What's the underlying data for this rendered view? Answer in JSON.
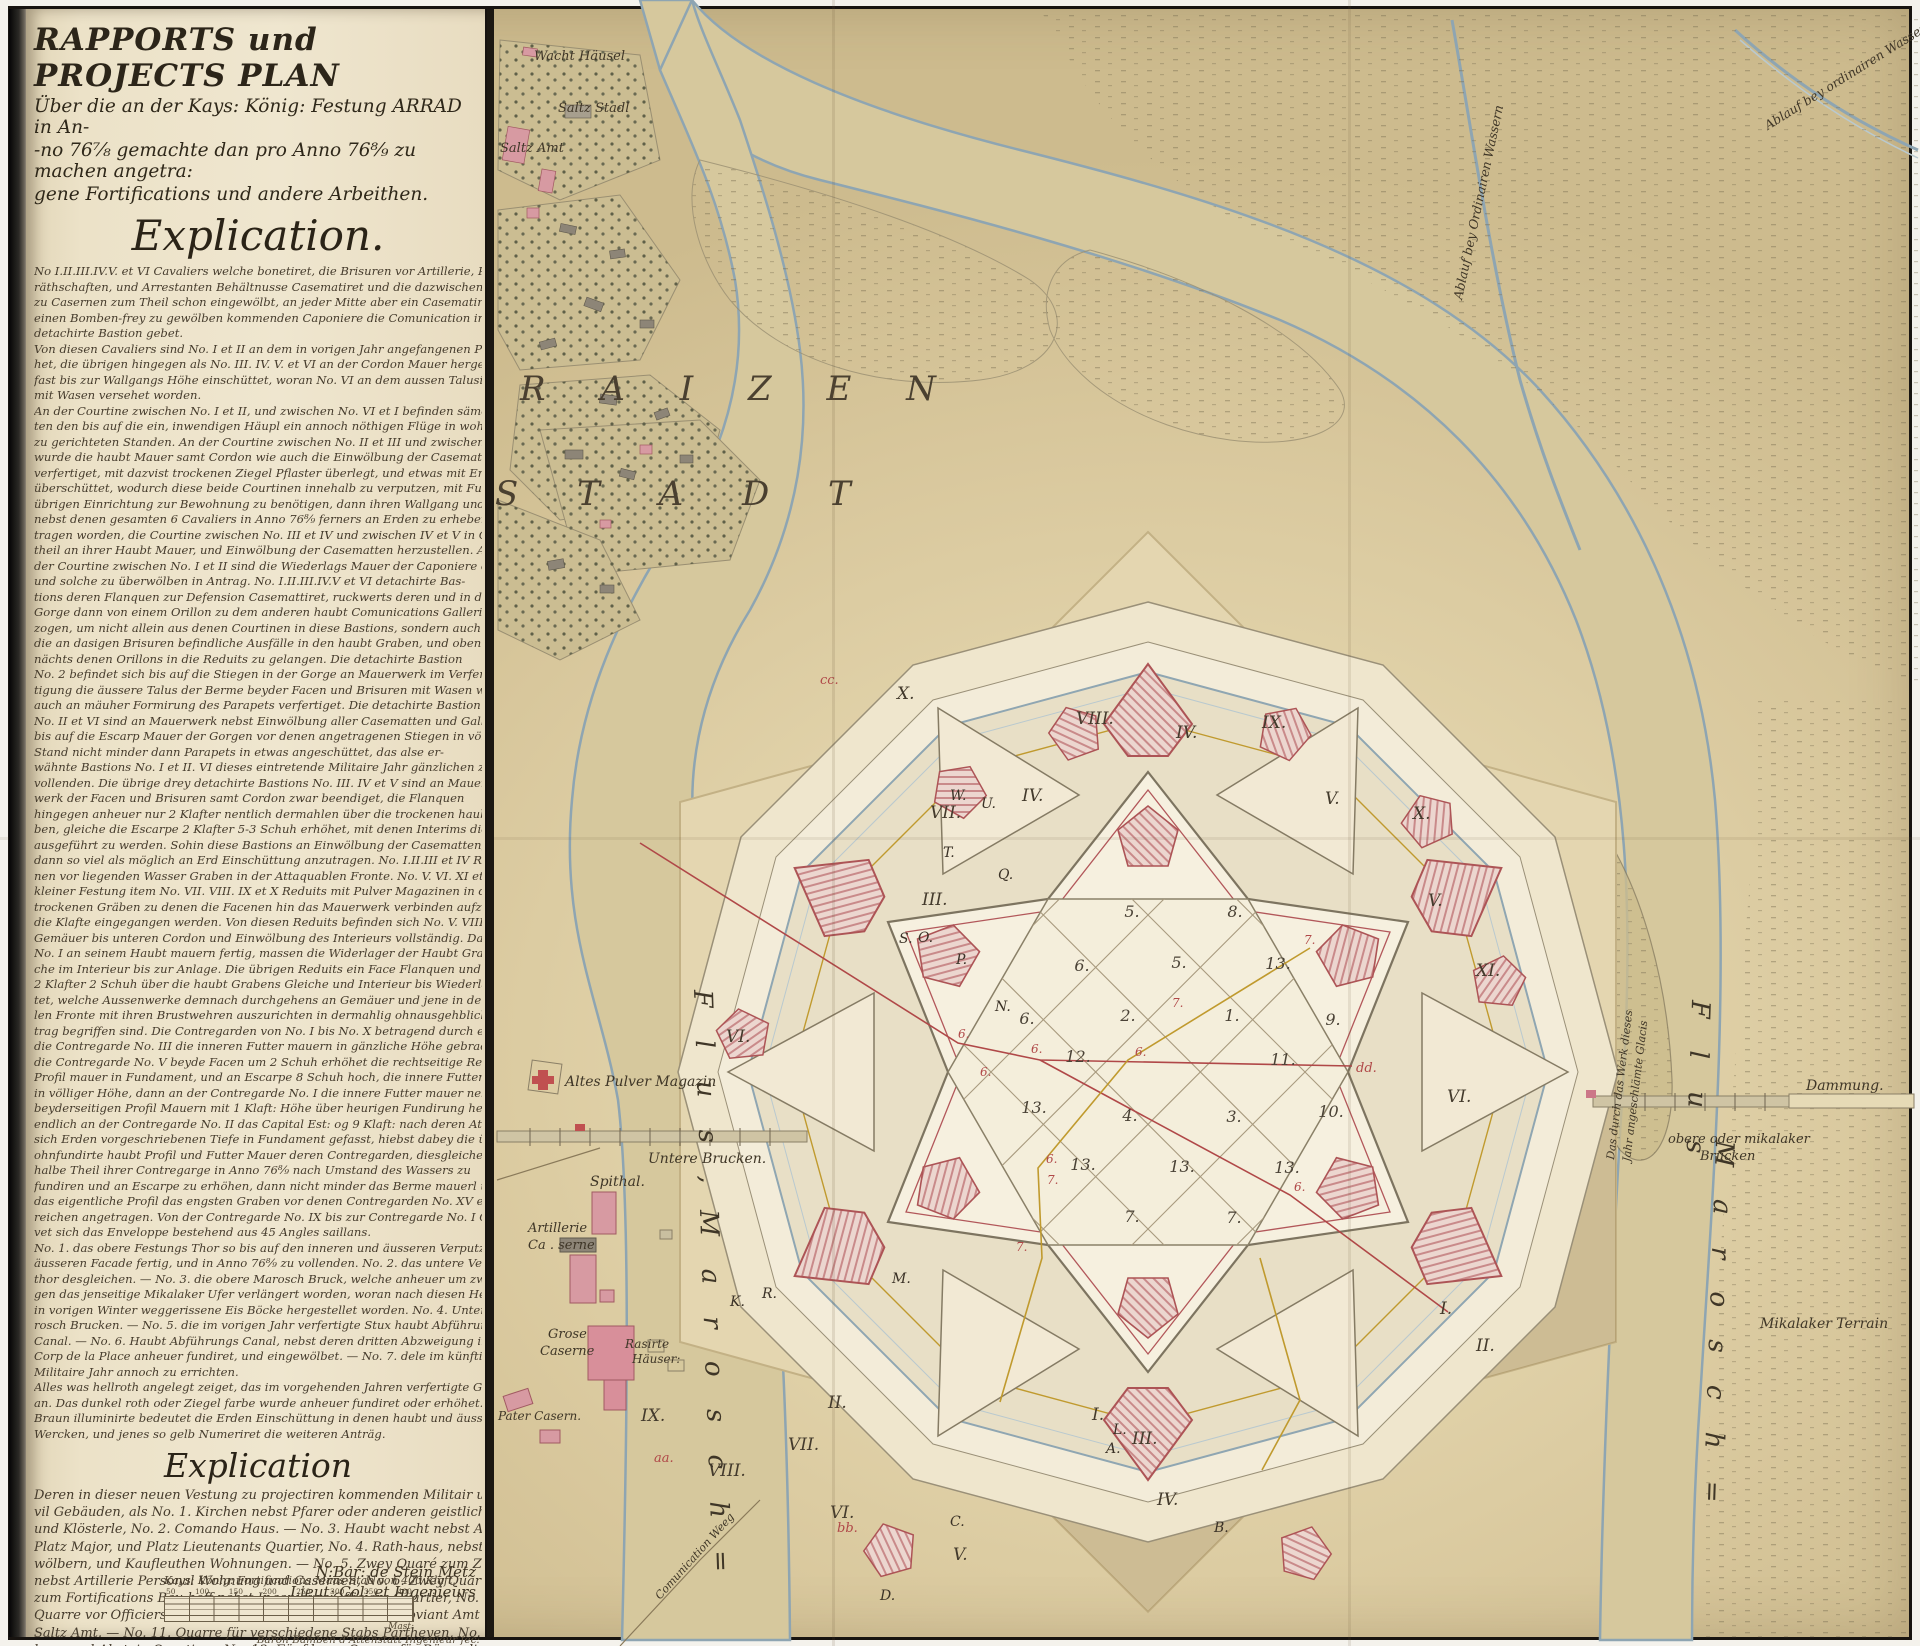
{
  "panel": {
    "title_line1": "RAPPORTS und PROJECTS PLAN",
    "title_line2": "Über die an der Kays: König: Festung ARRAD in An-",
    "title_line3": "-no 76⁷⁄₈ gemachte dan pro Anno 76⁸⁄₉ zu machen angetra:",
    "title_line4": "gene Fortifications und andere Arbeithen.",
    "explication_heading": "Explication.",
    "body_lines": [
      "No I.II.III.IV.V. et VI Cavaliers welche bonetiret, die Brisuren vor Artillerie, Proviant Ge-",
      "räthschaften, und Arrestanten Behältnusse Casematiret und die dazwischen liegende Courtinen",
      "zu Casernen zum Theil schon eingewölbt, an jeder Mitte aber ein Casematirter Ausfall durch",
      "einen Bomben-frey zu gewölben kommenden Caponiere die Comunication in die dorten liegende",
      "detachirte Bastion gebet.",
      "Von diesen Cavaliers sind No. I et II an dem in vorigen Jahr angefangenen Parapet ferners erhö-",
      "het, die übrigen hingegen als No. III. IV. V. et VI an der Cordon Mauer hergestellet, an Erden aber",
      "fast bis zur Wallgangs Höhe einschüttet, woran No. VI an dem aussen Talusirte Berme",
      "mit Wasen versehet worden.",
      "An der Courtine zwischen No. I et II, und zwischen No. VI et I befinden sämentliche Casemat-",
      "ten den bis auf die ein, inwendigen Häupl ein annoch nöthigen Flüge in wohnbaren",
      "zu gerichteten Standen. An der Courtine zwischen No. II et III und zwischen No. V et VI",
      "wurde die haubt Mauer samt Cordon wie auch die Einwölbung der Casematirten Casern",
      "verfertiget, mit dazvist trockenen Ziegel Pflaster überlegt, und etwas mit Erden",
      "überschüttet, wodurch diese beide Courtinen innehalb zu verputzen, mit Fussböden, und",
      "übrigen Einrichtung zur Bewohnung zu benötigen, dann ihren Wallgang und Brustwerke",
      "nebst denen gesamten 6 Cavaliers in Anno 76⁸⁄₉ ferners an Erden zu erheben, ange-",
      "tragen worden, die Courtine zwischen No. III et IV und zwischen IV et V in Gegen-",
      "theil an ihrer Haubt Mauer, und Einwölbung der Casematten herzustellen. An",
      "der Courtine zwischen No. I et II sind die Wiederlags Mauer der Caponiere errichtet,",
      "und solche zu überwölben in Antrag.    No. I.II.III.IV.V et VI detachirte Bas-",
      "tions deren Flanquen zur Defension Casemattiret, ruckwerts deren und in der",
      "Gorge dann von einem Orillon zu dem anderen haubt Comunications Gallerien ge-",
      "zogen, um nicht allein aus denen Courtinen in diese Bastions, sondern auch durch",
      "die an dasigen Brisuren befindliche Ausfälle in den haubt Graben, und oben",
      "nächts denen Orillons in die Reduits zu gelangen. Die detachirte Bastion",
      "No. 2 befindet sich bis auf die Stiegen in der Gorge an Mauerwerk im Verfer-",
      "tigung die äussere Talus der Berme beyder Facen und Brisuren mit Wasen wie",
      "auch an mäuher Formirung des Parapets verfertiget. Die detachirte Bastion",
      "No. II et VI sind an Mauerwerk nebst Einwölbung aller Casematten und Gallerien",
      "bis auf die Escarp Mauer der Gorgen vor denen angetragenen Stiegen in völlig neuen",
      "Stand nicht minder dann Parapets in etwas angeschüttet, das alse er-",
      "wähnte Bastions No. I et II. VI dieses eintretende Militaire Jahr gänzlichen zu",
      "vollenden. Die übrige drey detachirte Bastions No. III. IV et V sind an Mauer-",
      "werk der Facen und Brisuren samt Cordon zwar beendiget, die Flanquen",
      "hingegen anheuer nur 2 Klafter nentlich dermahlen über die trockenen haubt Grä-",
      "ben, gleiche die Escarpe 2 Klafter 5-3 Schuh erhöhet, mit denen Interims die Wiederlager",
      "ausgeführt zu werden. Sohin diese Bastions an Einwölbung der Casematten, und Gallerien,",
      "dann so viel als möglich an Erd Einschüttung anzutragen.    No. I.II.III et IV Reduits mit de-",
      "nen vor liegenden Wasser Graben in der Attaquablen Fronte. No. V. VI. XI et XII Reduits",
      "kleiner Festung item No. VII. VIII. IX et X Reduits mit Pulver Magazinen in denen",
      "trockenen Gräben zu denen die Facenen hin das Mauerwerk verbinden aufzuen,",
      "die Klafte eingegangen werden. Von diesen Reduits befinden sich No. V. VIII et VI an haubt",
      "Gemäuer bis unteren Cordon und Einwölbung des Interieurs vollständig. Das Reduit",
      "No. I an seinem Haubt mauern fertig, massen die Widerlager der Haubt Graben und sol-",
      "che im Interieur bis zur Anlage. Die übrigen Reduits ein Face Flanquen und Gorge mauern",
      "2 Klafter 2 Schuh über die haubt Grabens Gleiche und Interieur bis Wiederlager errich-",
      "tet, welche Aussenwerke demnach durchgehens an Gemäuer und jene in der attaquab-",
      "len Fronte mit ihren Brustwehren auszurichten in dermahlig ohnausgehbliche An-",
      "trag begriffen sind. Die Contregarden von No. I bis No. X betragend durch einziegen",
      "die Contregarde No. III die inneren Futter mauern in gänzliche Höhe gebracht, an",
      "die Contregarde No. V beyde Facen um 2 Schuh erhöhet die rechtseitige Rekierung nebst",
      "Profil mauer in Fundament, und an Escarpe 8 Schuh hoch, die innere Futter mauer aber",
      "in völliger Höhe, dann an der Contregarde No. I die innere Futter mauer nebst",
      "beyderseitigen Profil Mauern mit 1 Klaft: Höhe über heurigen Fundirung hergestellt, und",
      "endlich an der Contregarde No. II das Capital Est: og 9 Klaft: nach deren Attechoik",
      "sich Erden vorgeschriebenen Tiefe in Fundament gefasst, hiebst dabey die übrige noch",
      "ohnfundirte haubt Profil und Futter Mauer deren Contregarden, diesgleichende",
      "halbe Theil ihrer Contregarge in Anno 76⁸⁄₉ nach Umstand des Wassers zu",
      "fundiren und an Escarpe zu erhöhen, dann nicht minder das Berme mauerl um",
      "das eigentliche Profil das engsten Graben vor denen Contregarden No. XV et XI aus-",
      "reichen angetragen. Von der Contregarde No. IX bis zur Contregarde No. I Contre-",
      "vet sich das Enveloppe bestehend aus 45 Angles saillans.",
      "No. 1. das obere Festungs Thor so bis auf den inneren und äusseren Verputz dann",
      "äusseren Facade fertig, und in Anno 76⁸⁄₉ zu vollenden. No. 2. das untere Vestungs",
      "thor desgleichen. — No. 3. die obere Marosch Bruck, welche anheuer um zwey Joch ge-",
      "gen das jenseitige Mikalaker Ufer verlängert worden, woran nach diesen Herbst die",
      "in vorigen Winter weggerissene Eis Böcke hergestellet worden. No. 4. Untere Ma-",
      "rosch Brucken. — No. 5. die im vorigen Jahr verfertigte Stux haubt Abführungs",
      "Canal. — No. 6. Haubt Abführungs Canal, nebst deren dritten Abzweigung in dem",
      "Corp de la Place anheuer fundiret, und eingewölbet. — No. 7. dele im künftigen",
      "Militaire Jahr annoch zu errichten.",
      "Alles was hellroth angelegt zeiget, das im vorgehenden Jahren verfertigte Gemäuer",
      "an. Das dunkel roth oder Ziegel farbe wurde anheuer fundiret oder erhöhet. Das",
      "Braun illuminirte bedeutet die Erden Einschüttung in denen haubt und äusseren",
      "Wercken, und jenes so gelb Numeriret die weiteren Anträg."
    ],
    "explication2_heading": "Explication",
    "body2_lines": [
      "Deren in dieser neuen Vestung zu projectiren kommenden Militair und Ci-",
      "vil Gebäuden, als No. 1. Kirchen nebst Pfarer oder anderen geistlichen Wohnung",
      "und Klösterle, No. 2. Comando Haus. — No. 3. Haubt wacht nebst Arrestanten,",
      "Platz Major, und Platz Lieutenants Quartier, No. 4. Rath-haus, nebst Zinsge-",
      "wölbern, und Kaufleuthen Wohnungen. — No. 5. Zwey Quaré zum Zeughaus",
      "nebst Artillerie Personal Wohnung und Casernen, No. 6. Zwey Quarre",
      "zum Fortifications Bau-hoff nebst Ingenieurs Officiers Quartier, No. 7. Zwey",
      "Quarre vor Officiers Caserne, No. 8. Hospithal, No. 9. Proviant Amt et No. 10.",
      "Saltz Amt. — No. 11. Quarre für verschiedene Stabs Partheyen, No. 12. Für Wirths-",
      "haus und Absteig Quartiers, No. 13. Fünf leere Quarre für Bürgerliche",
      "und andere Häuser."
    ],
    "signature_line1": "N:Bar: de Stein Metz",
    "signature_line2": "Lieut: Col: et Ingenieurs",
    "scale": {
      "title": "Kays: König: Fortifications Maas-Stab von 400 Klaft.",
      "ticks": [
        "50",
        "100",
        "150",
        "200",
        "250",
        "300",
        "350",
        "400"
      ],
      "end": "Mast:"
    },
    "credit": "Baron Bamben d'Attenstatt Ingenieur fec:"
  },
  "map": {
    "labels": {
      "wacht_hausel": "Wacht Häusel",
      "saltz_stadl": "Saltz Stadl",
      "saltz_amt": "Saltz Amt",
      "raizen": "R A I Z E N",
      "stadt": "S T A D T",
      "ablauf_left": "Ablauf bey Ordinairen Wassern",
      "ablauf_right": "Ablauf bey ordinairen Wassern",
      "flus_left": "F l u s ,",
      "marosch_left": "M a r o s c h =",
      "flus_right": "F l u s",
      "marosch_right": "M a r o s c h =",
      "altes_pulver": "Altes Pulver Magazin",
      "untere_brucken": "Untere Brucken.",
      "spithal": "Spithal.",
      "artillerie_1": "Artillerie",
      "artillerie_2": "Ca . serne",
      "grose_caserne_1": "Grose",
      "grose_caserne_2": "Caserne",
      "rasirte_1": "Rasirte",
      "rasirte_2": "Häuser:",
      "pater_casern": "Pater Casern.",
      "comunication": "Comunication Weeg",
      "obere_brucken_1": "obere oder mikalaker",
      "obere_brucken_2": "Brucken",
      "dammung": "Dammung.",
      "mikalaker": "Mikalaker Terrain",
      "angeschlemte_1": "Das durch das Werk dieses",
      "angeschlemte_2": "Jahr angeschlämte Glacis"
    },
    "numerals": {
      "n01": "X.",
      "n02": "VIII.",
      "n03": "IV.",
      "n04": "IX.",
      "n05": "IV.",
      "n06": "VII.",
      "n07": "V.",
      "n08": "X.",
      "n09": "V.",
      "n10": "XI.",
      "n11": "VI.",
      "n12": "I.",
      "n13": "II.",
      "n14": "III.",
      "n15": "VI.",
      "n16": "IX.",
      "n17": "VIII.",
      "n18": "VII.",
      "n19": "II.",
      "n20": "V.",
      "n21": "VI.",
      "n22": "III.",
      "n23": "IV.",
      "n24": "I."
    },
    "letters": {
      "w": "W.",
      "u": "U.",
      "t": "T.",
      "q": "Q.",
      "s": "S.",
      "o": "O.",
      "p": "P.",
      "n": "N.",
      "m": "M.",
      "r": "R.",
      "k": "K.",
      "a": "A.",
      "l": "L.",
      "b": "B.",
      "c": "C.",
      "d": "D.",
      "aa": "aa.",
      "bb": "bb.",
      "cc": "cc.",
      "dd": "dd."
    },
    "blocks": {
      "b01": "5.",
      "b02": "8.",
      "b03": "6.",
      "b04": "5.",
      "b05": "13.",
      "b06": "6.",
      "b07": "2.",
      "b08": "1.",
      "b09": "9.",
      "b10": "12.",
      "b11": "11.",
      "b12": "13.",
      "b13": "4.",
      "b14": "3.",
      "b15": "10.",
      "b16": "13.",
      "b17": "13.",
      "b18": "13.",
      "b19": "7.",
      "b20": "7."
    },
    "red_marks": {
      "six": "6.",
      "seven": "7."
    },
    "colors": {
      "paper": "#dccda2",
      "panel_paper": "#ece2c8",
      "water_edge": "#8ea5b2",
      "masonry_pink": "#e8c4bc",
      "masonry_red": "#ad5456",
      "project_yellow": "#c09a2e",
      "profile_red": "#b04848",
      "ink": "#3a3126"
    }
  }
}
